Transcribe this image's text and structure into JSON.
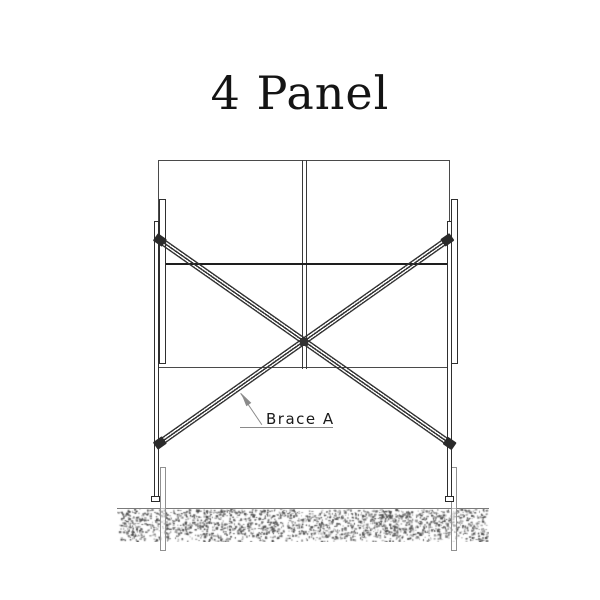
{
  "title": "4 Panel",
  "annotation": {
    "label": "Brace A"
  },
  "colors": {
    "background": "#ffffff",
    "line": "#2f2f2f",
    "line_strong": "#1e1e1e",
    "panel_outline": "#4a4a4a",
    "brace": "#333333",
    "leader_gray": "#8a8a8a",
    "buried_tube_gray": "#909090",
    "ground_line": "#7a7a7a",
    "ground_dots": "#4a4a4a",
    "title_text": "#141414",
    "label_text": "#1a1a1a"
  }
}
